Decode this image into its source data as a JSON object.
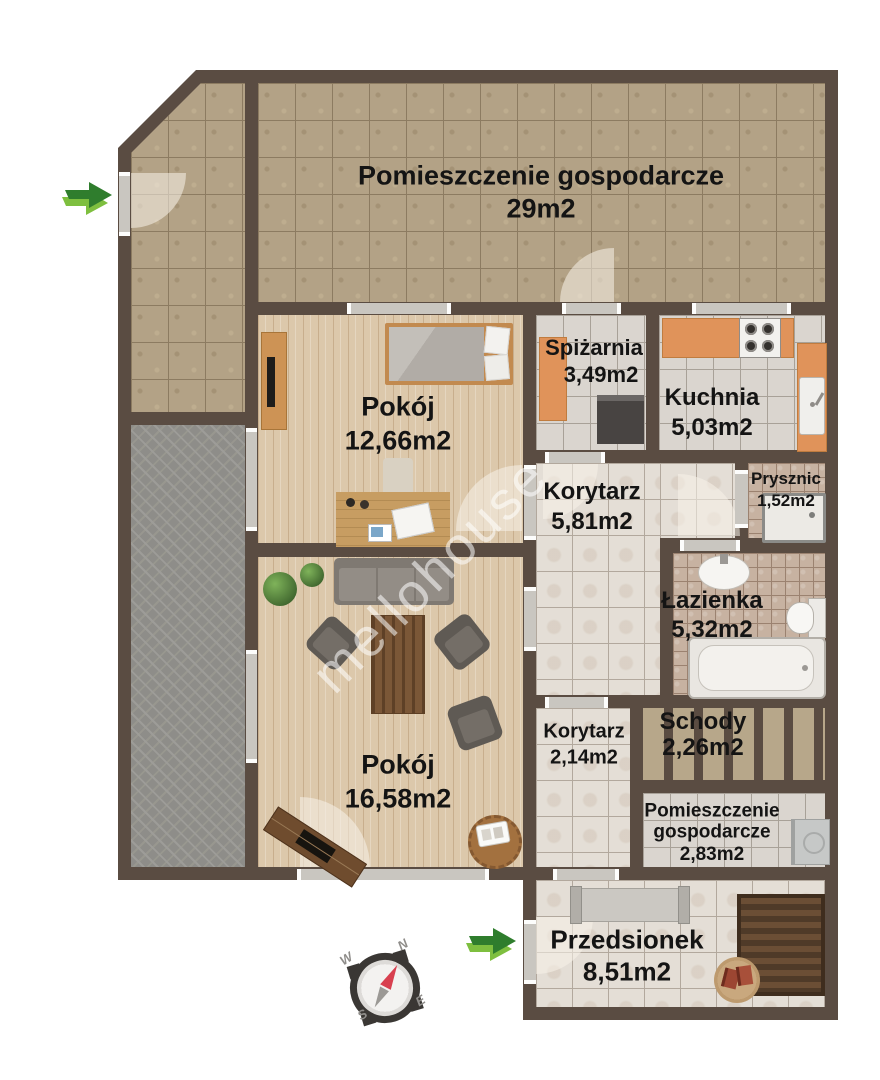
{
  "watermark": "mellohouse",
  "rooms": {
    "utility_top": {
      "name": "Pomieszczenie gospodarcze",
      "area": "29m2"
    },
    "bedroom": {
      "name": "Pokój",
      "area": "12,66m2"
    },
    "pantry": {
      "name": "Spiżarnia",
      "area": "3,49m2"
    },
    "kitchen": {
      "name": "Kuchnia",
      "area": "5,03m2"
    },
    "hall_main": {
      "name": "Korytarz",
      "area": "5,81m2"
    },
    "shower": {
      "name": "Prysznic",
      "area": "1,52m2"
    },
    "bathroom": {
      "name": "Łazienka",
      "area": "5,32m2"
    },
    "living": {
      "name": "Pokój",
      "area": "16,58m2"
    },
    "hall_small": {
      "name": "Korytarz",
      "area": "2,14m2"
    },
    "stairs": {
      "name": "Schody",
      "area": "2,26m2"
    },
    "utility_small": {
      "name": "Pomieszczenie gospodarcze",
      "area": "2,83m2"
    },
    "vestibule": {
      "name": "Przedsionek",
      "area": "8,51m2"
    }
  },
  "compass": {
    "n": "N",
    "e": "E",
    "s": "S",
    "w": "W"
  },
  "icons": {
    "entrance_arrow": "right-arrow",
    "compass_rose": "compass"
  },
  "colors": {
    "wall": "#5a4c42",
    "arrow_dark_green": "#2f7d2d",
    "arrow_light_green": "#7ebf3f",
    "compass_needle_red": "#d8404f",
    "cabinet_orange": "#e0935a",
    "tile_tan": "#b3a286",
    "tile_gray": "#dad5cf",
    "tile_beige": "#e4ded6",
    "tile_mosaic": "#c7b2a1",
    "floor_wood": "#dcc8ab",
    "terrace_gray": "#8e8d89"
  }
}
